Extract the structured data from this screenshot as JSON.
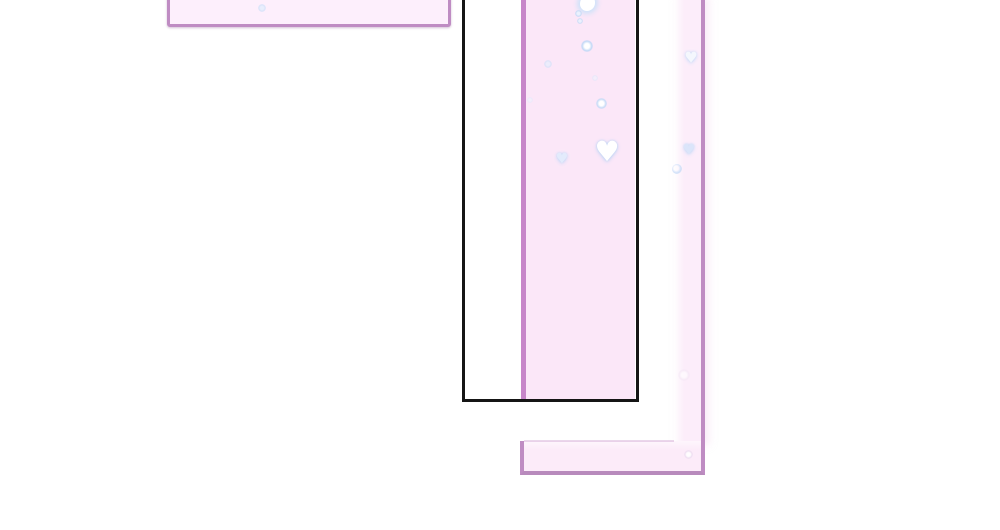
{
  "canvas": {
    "width": 1000,
    "height": 530,
    "background": "#ffffff"
  },
  "colors": {
    "background": "#ffffff",
    "panel_border_purple": "#bf8cc3",
    "strip_border_purple": "#c786c9",
    "bar_border_purple": "#b88abc",
    "frame_border_black": "#151515",
    "card_fill": "#fdeffc",
    "strip_fill": "#fbe7f8",
    "right_strip_fill": "#fcedfa",
    "bar_fill": "#fcebf9",
    "sparkle_white": "#ffffff",
    "sparkle_blue": "#c6daf6"
  },
  "panels": {
    "topLeftCard": {
      "left": 167,
      "top": -6,
      "width": 284,
      "height": 33,
      "fill": "#fdeffc"
    },
    "centerStrip": {
      "left": 521,
      "top": -3,
      "width": 114,
      "height": 403,
      "fill": "#fbe7f8"
    },
    "rightStrip": {
      "left": 674,
      "top": -3,
      "width": 31,
      "height": 448,
      "fill": "#fcedfa"
    },
    "bottomBar": {
      "left": 520,
      "top": 441,
      "width": 185,
      "height": 34,
      "fill": "#fcebf9"
    },
    "bottomBarTopEdge": {
      "left": 524,
      "top": 440,
      "width": 150,
      "height": 2,
      "fill": "rgba(199,151,203,0.38)"
    },
    "blackFrame": {
      "left": 462,
      "top": -6,
      "width": 177,
      "height": 408,
      "fill": "transparent"
    }
  },
  "sparkles": [
    {
      "name": "card-dot",
      "type": "dot",
      "x": 262,
      "y": 8,
      "size": 8,
      "core": "#e4eefd",
      "halo": "#cfe0f8",
      "opacity": 0.8
    },
    {
      "name": "strip-top-blob",
      "type": "blob",
      "x": 587,
      "y": 3,
      "size": 15,
      "core": "#ffffff",
      "halo": "#cfe2f9",
      "opacity": 1
    },
    {
      "name": "strip-dot",
      "type": "dot",
      "x": 578,
      "y": 13,
      "size": 7,
      "core": "#eaf2fe",
      "halo": "#c6daf6",
      "opacity": 0.95
    },
    {
      "name": "strip-dot",
      "type": "dot",
      "x": 580,
      "y": 21,
      "size": 6,
      "core": "#eaf2fe",
      "halo": "#c6daf6",
      "opacity": 0.9
    },
    {
      "name": "strip-sparkle",
      "type": "dot",
      "x": 587,
      "y": 46,
      "size": 12,
      "core": "#ffffff",
      "halo": "#c2d8f6",
      "opacity": 1
    },
    {
      "name": "strip-dot-faint",
      "type": "dot",
      "x": 548,
      "y": 64,
      "size": 8,
      "core": "#e6effd",
      "halo": "#cfe0f8",
      "opacity": 0.7
    },
    {
      "name": "strip-dot-faint",
      "type": "dot",
      "x": 595,
      "y": 78,
      "size": 6,
      "core": "#eef4fe",
      "halo": "#d8e6fa",
      "opacity": 0.55
    },
    {
      "name": "strip-sparkle",
      "type": "dot",
      "x": 601,
      "y": 103,
      "size": 11,
      "core": "#ffffff",
      "halo": "#c6daf6",
      "opacity": 1
    },
    {
      "name": "strip-dot-faint",
      "type": "dot",
      "x": 530,
      "y": 100,
      "size": 6,
      "core": "#eef4fe",
      "halo": "#dce9fc",
      "opacity": 0.5
    },
    {
      "name": "strip-big-heart",
      "type": "heart",
      "x": 607,
      "y": 152,
      "size": 24,
      "core": "#ffffff",
      "halo": "#bcd4f4",
      "opacity": 1
    },
    {
      "name": "strip-heart",
      "type": "heart",
      "x": 562,
      "y": 159,
      "size": 12,
      "core": "#e2ecfd",
      "halo": "#c2d8f6",
      "opacity": 0.95
    },
    {
      "name": "rstrip-heart",
      "type": "heart",
      "x": 691,
      "y": 58,
      "size": 13,
      "core": "#f4f8fe",
      "halo": "#c6daf6",
      "opacity": 0.95
    },
    {
      "name": "rstrip-heart",
      "type": "heart",
      "x": 689,
      "y": 150,
      "size": 12,
      "core": "#d8e5fa",
      "halo": "#c2d8f6",
      "opacity": 0.9
    },
    {
      "name": "rstrip-ring",
      "type": "ring",
      "x": 677,
      "y": 169,
      "size": 10,
      "core": "#d8e5fa",
      "halo": "#c6daf6",
      "opacity": 0.85
    },
    {
      "name": "rstrip-dot-faint",
      "type": "dot",
      "x": 684,
      "y": 375,
      "size": 12,
      "core": "#ffffff",
      "halo": "#f3e6f4",
      "opacity": 0.6
    },
    {
      "name": "corner-dot",
      "type": "dot",
      "x": 688,
      "y": 454,
      "size": 9,
      "core": "#ffffff",
      "halo": "#ecdcf0",
      "opacity": 0.9
    }
  ]
}
